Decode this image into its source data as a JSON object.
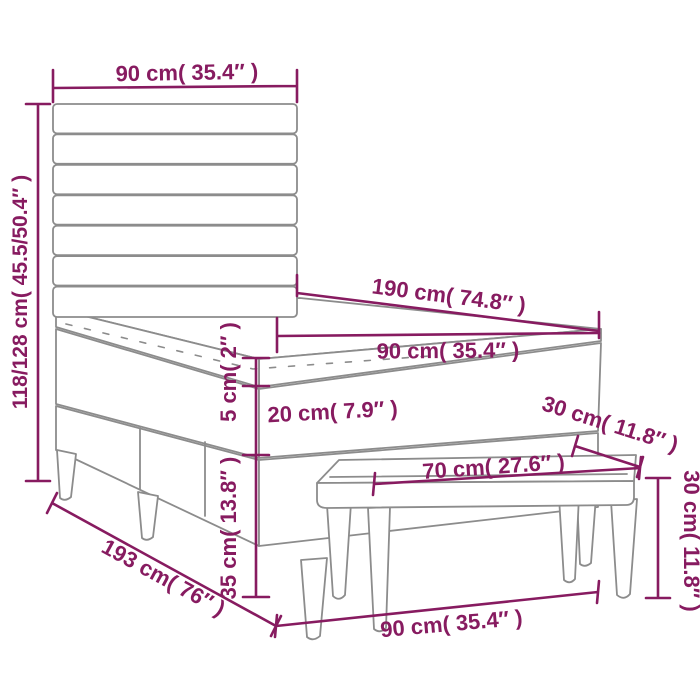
{
  "diagram": {
    "title": "bed-with-bench-dimensions-diagram",
    "colors": {
      "dimension": "#871B60",
      "furniture_outline": "#8C8C8C",
      "background": "#FFFFFF"
    },
    "labels": {
      "headboard_width": "90 cm( 35.4″ )",
      "total_height": "118/128 cm( 45.5/50.4″ )",
      "mattress_length": "190 cm( 74.8″ )",
      "mattress_width": "90 cm( 35.4″ )",
      "topper_height": "5 cm( 2″ )",
      "mattress_height": "20 cm( 7.9″ )",
      "bench_depth": "30 cm( 11.8″ )",
      "bench_length": "70 cm( 27.6″ )",
      "base_height": "35 cm( 13.8″ )",
      "bed_total_length": "193 cm( 76″ )",
      "bed_width": "90 cm( 35.4″ )",
      "bench_height": "30 cm( 11.8″ )"
    },
    "dimensions": [
      {
        "name": "headboard width",
        "value_cm": "90",
        "value_in": "35.4"
      },
      {
        "name": "headboard height range",
        "value_cm": "118/128",
        "value_in": "45.5/50.4"
      },
      {
        "name": "mattress length",
        "value_cm": "190",
        "value_in": "74.8"
      },
      {
        "name": "mattress width",
        "value_cm": "90",
        "value_in": "35.4"
      },
      {
        "name": "topper height",
        "value_cm": "5",
        "value_in": "2"
      },
      {
        "name": "mattress height",
        "value_cm": "20",
        "value_in": "7.9"
      },
      {
        "name": "bench depth",
        "value_cm": "30",
        "value_in": "11.8"
      },
      {
        "name": "bench length",
        "value_cm": "70",
        "value_in": "27.6"
      },
      {
        "name": "base height",
        "value_cm": "35",
        "value_in": "13.8"
      },
      {
        "name": "bed total length",
        "value_cm": "193",
        "value_in": "76"
      },
      {
        "name": "bed width",
        "value_cm": "90",
        "value_in": "35.4"
      },
      {
        "name": "bench height",
        "value_cm": "30",
        "value_in": "11.8"
      }
    ]
  }
}
